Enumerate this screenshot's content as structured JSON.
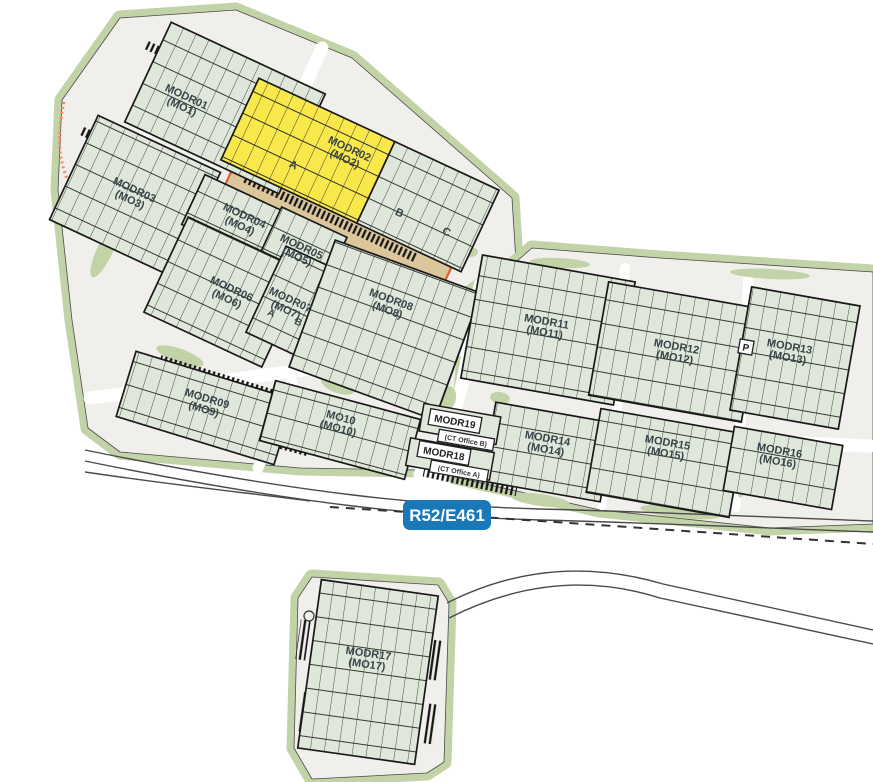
{
  "plan": {
    "road_sign": "R52/E461",
    "parking_badge": "P",
    "buildings": [
      {
        "id": "modr01",
        "name": "MODR01",
        "code": "(MO1)"
      },
      {
        "id": "modr02",
        "name": "MODR02",
        "code": "(MO2)",
        "highlighted": true,
        "highlighted_section": "A"
      },
      {
        "id": "modr03",
        "name": "MODR03",
        "code": "(MO3)"
      },
      {
        "id": "modr04",
        "name": "MODR04",
        "code": "(MO4)"
      },
      {
        "id": "modr05",
        "name": "MODR05",
        "code": "(MO5)"
      },
      {
        "id": "modr06",
        "name": "MODR06",
        "code": "(MO6)"
      },
      {
        "id": "modr07",
        "name": "MODR07",
        "code": "(MO7)"
      },
      {
        "id": "modr08",
        "name": "MODR08",
        "code": "(MO8)"
      },
      {
        "id": "modr09",
        "name": "MODR09",
        "code": "(MO9)"
      },
      {
        "id": "modr10",
        "name": "MO10",
        "code": "(MO10)"
      },
      {
        "id": "modr11",
        "name": "MODR11",
        "code": "(MO11)"
      },
      {
        "id": "modr12",
        "name": "MODR12",
        "code": "(MO12)"
      },
      {
        "id": "modr13",
        "name": "MODR13",
        "code": "(MO13)"
      },
      {
        "id": "modr14",
        "name": "MODR14",
        "code": "(MO14)"
      },
      {
        "id": "modr15",
        "name": "MODR15",
        "code": "(MO15)"
      },
      {
        "id": "modr16",
        "name": "MODR16",
        "code": "(MO16)"
      },
      {
        "id": "modr17",
        "name": "MODR17",
        "code": "(MO17)"
      }
    ],
    "offices": [
      {
        "id": "modr19",
        "name": "MODR19",
        "code": "(CT Office B)"
      },
      {
        "id": "modr18",
        "name": "MODR18",
        "code": "(CT Office A)"
      }
    ],
    "sections_modr02": [
      "A",
      "B",
      "C"
    ],
    "sections_modr07": [
      "A",
      "B"
    ],
    "colors": {
      "highlight_yellow": "#f9e84a",
      "building_fill": "#dfe7da",
      "landscape_green": "#c3d3a8",
      "apron_tan": "#dcc69c",
      "apron_border": "#e8582c",
      "sign_blue": "#1878b8",
      "label_text": "#394449"
    }
  }
}
